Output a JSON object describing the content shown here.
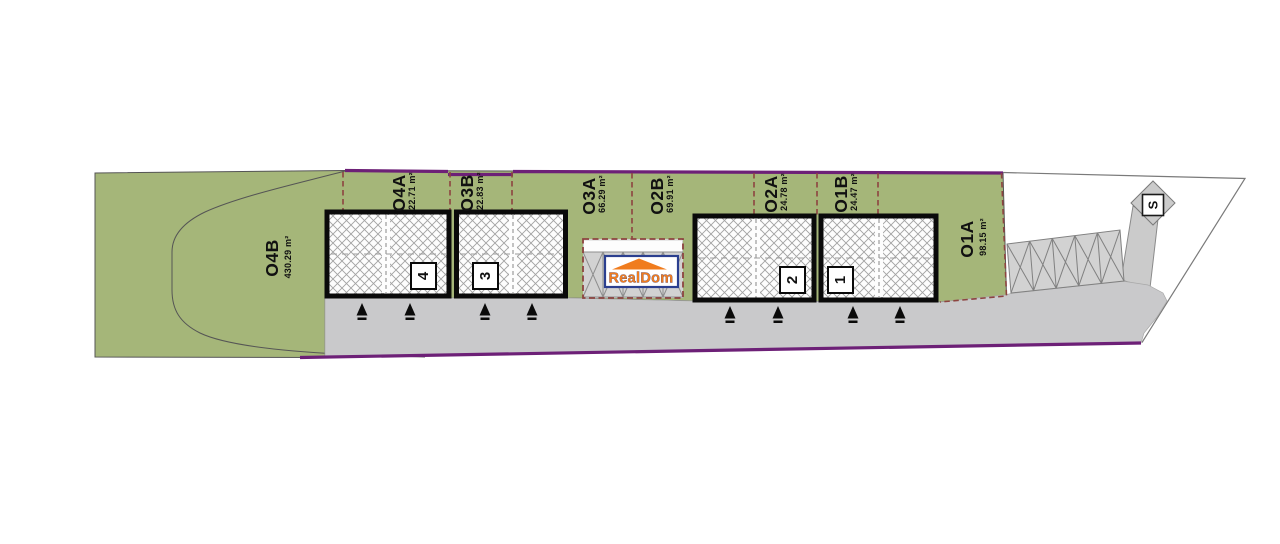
{
  "site_plan": {
    "title": "RealDom garage development site plan",
    "plots": [
      {
        "id": "O4B",
        "area": "430.29 m²"
      },
      {
        "id": "O4A",
        "area": "22.71 m²"
      },
      {
        "id": "O3B",
        "area": "22.83 m²"
      },
      {
        "id": "O3A",
        "area": "66.29 m²"
      },
      {
        "id": "O2B",
        "area": "69.91 m²"
      },
      {
        "id": "O2A",
        "area": "24.78 m²"
      },
      {
        "id": "O1B",
        "area": "24.47 m²"
      },
      {
        "id": "O1A",
        "area": "98.15 m²"
      }
    ],
    "units": [
      {
        "number": "4"
      },
      {
        "number": "3"
      },
      {
        "number": "2"
      },
      {
        "number": "1"
      }
    ],
    "septic_label": "S",
    "logo": {
      "text": "RealDom"
    },
    "colors": {
      "lawn_green": "#a5b679",
      "road_gray": "#c9c9cb",
      "parking_gray": "#d2d2d2",
      "boundary_purple": "#6d2077",
      "divider_maroon": "#8d4440",
      "logo_orange": "#f07c1e",
      "logo_blue": "#2b3f8f"
    }
  }
}
